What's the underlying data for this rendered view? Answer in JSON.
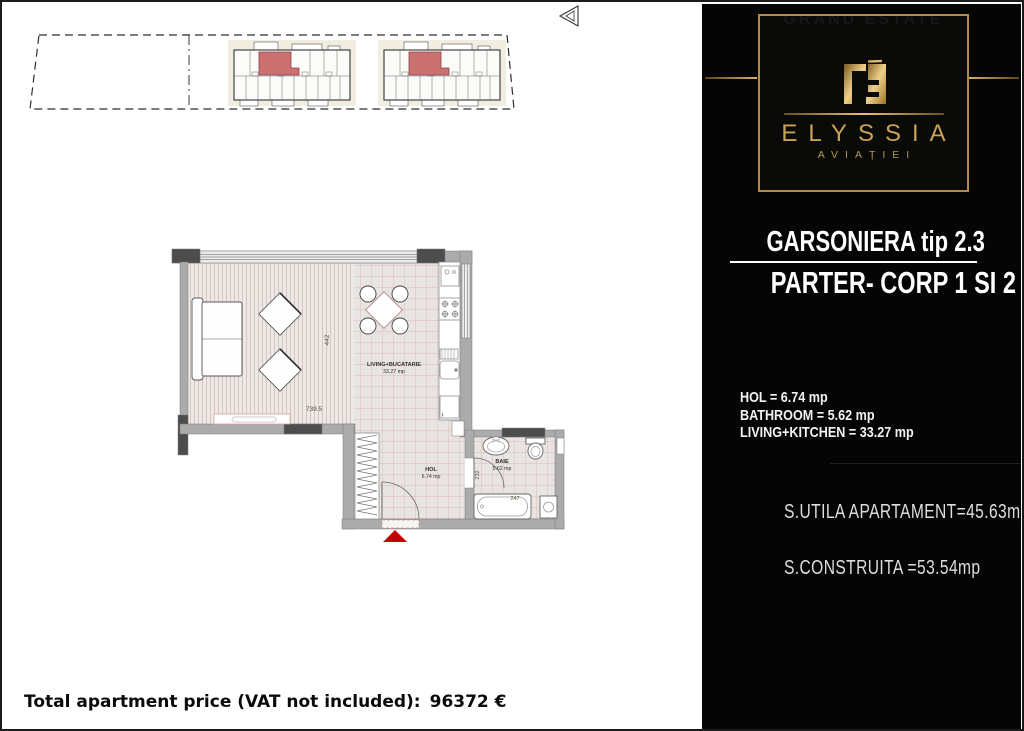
{
  "brand": {
    "logo_faint_text": "GRAND ESTATE",
    "name": "ELYSSIA",
    "location": "AVIAȚIEI",
    "gold_color": "#c9a254"
  },
  "unit": {
    "title": "GARSONIERA tip 2.3",
    "floor_line": "PARTER- CORP 1 SI 2",
    "room_lines": [
      "HOL = 6.74 mp",
      "BATHROOM = 5.62 mp",
      "LIVING+KITCHEN = 33.27 mp"
    ],
    "area_lines": [
      "S.UTILA  APARTAMENT=45.63mp",
      "S.CONSTRUITA  =53.54mp"
    ]
  },
  "price": {
    "label": "Total apartment price (VAT not included):",
    "value": "96372 €"
  },
  "floor_plan": {
    "living_label": "LIVING+BUCATARIE",
    "living_area": "33.27 mp",
    "hol_label": "HOL",
    "hol_area": "6.74 mp",
    "bath_label": "BAIE",
    "bath_area": "5.62 mp",
    "dim_height": "442",
    "dim_width": "739.5",
    "dim_bath_door": "232",
    "dim_tub": "247",
    "entrance_color": "#c40000",
    "highlight_color": "#cb7171"
  }
}
